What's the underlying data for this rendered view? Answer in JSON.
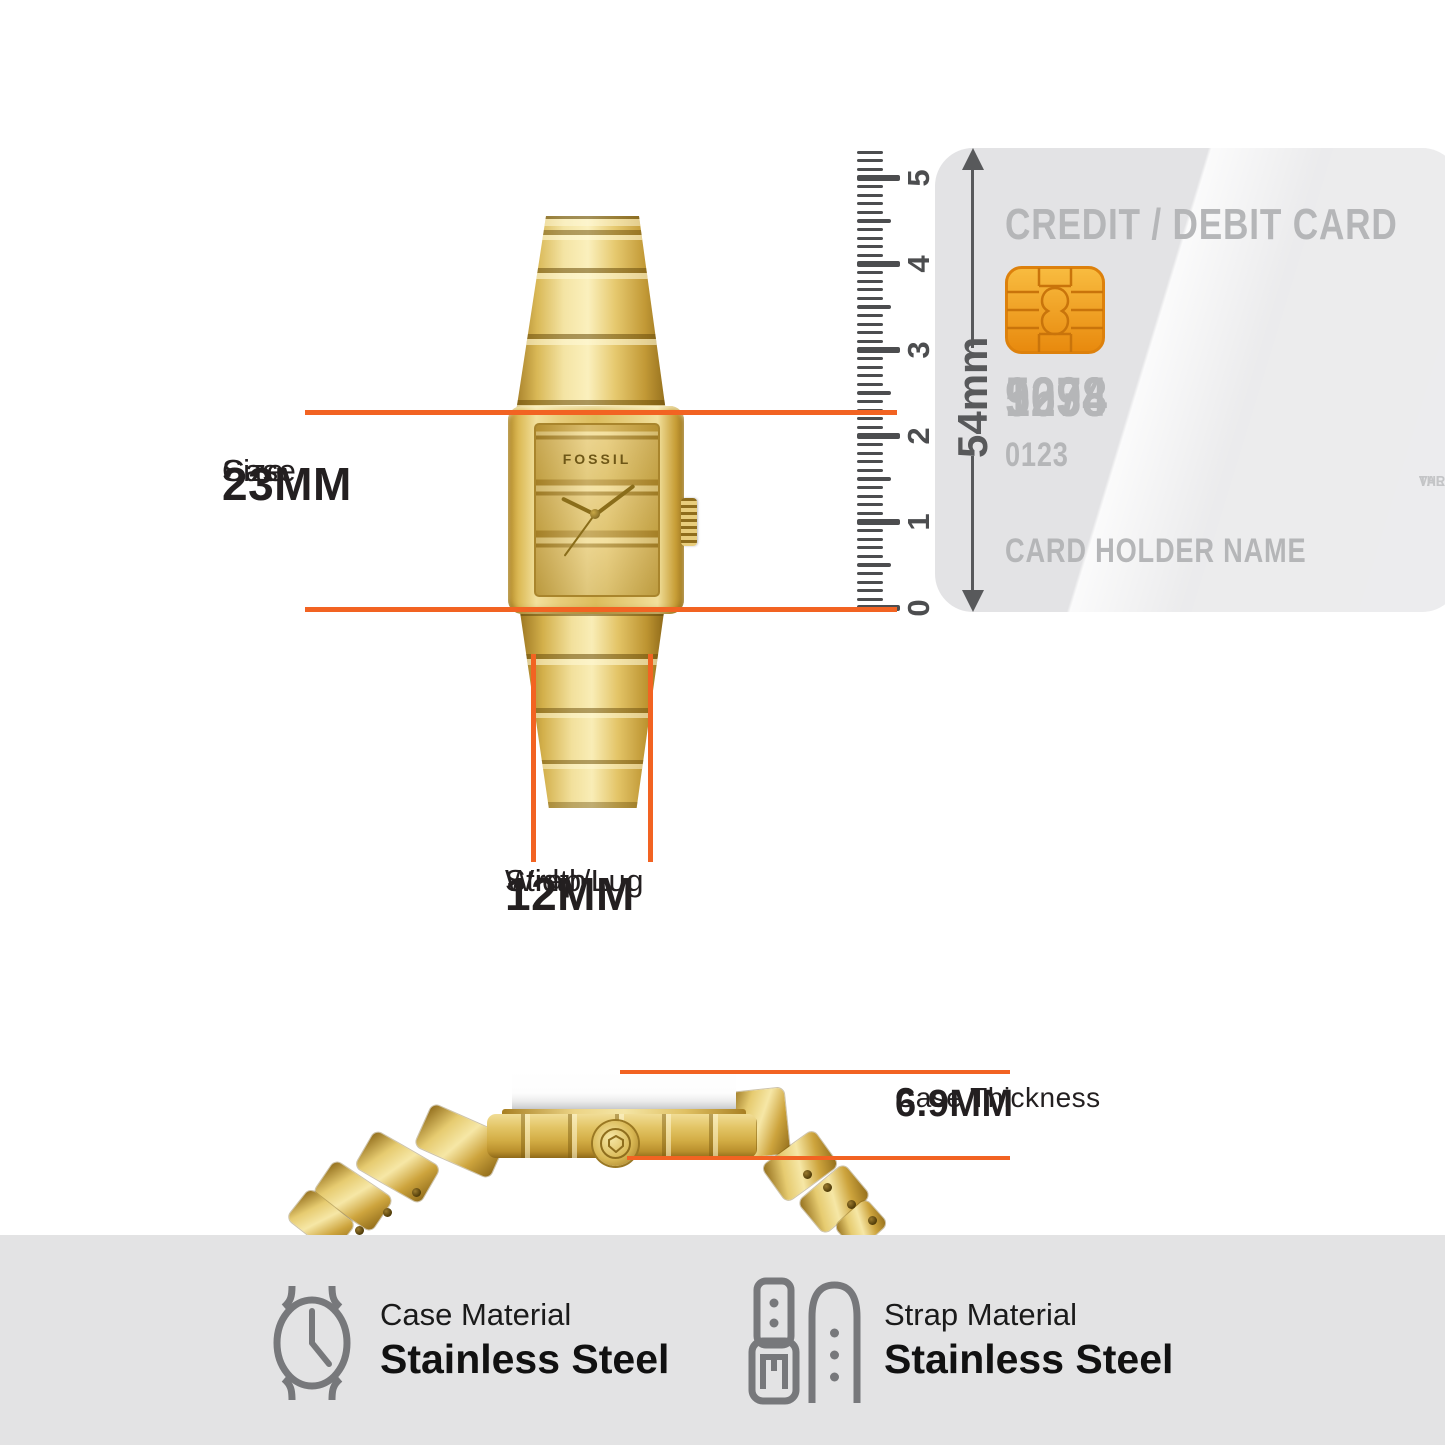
{
  "measurements": {
    "case_size": {
      "label_lines": [
        "Case",
        "Size"
      ],
      "value": "23MM"
    },
    "strap_width": {
      "label_lines": [
        "Strap/Lug",
        "Width"
      ],
      "value": "12MM"
    },
    "case_thickness": {
      "label": "Case Thickness",
      "value": "6.9MM"
    }
  },
  "ruler": {
    "max_value": 5,
    "step": 0.1,
    "overshoot": 0.3,
    "px_per_unit": 86,
    "zero_y": 608,
    "labels": [
      "0",
      "1",
      "2",
      "3",
      "4",
      "5"
    ]
  },
  "card": {
    "title": "CREDIT / DEBIT CARD",
    "height_label": "54mm",
    "number_groups": [
      "1234",
      "5678",
      "9098"
    ],
    "issue_number": "0123",
    "holder_label": "CARD HOLDER NAME",
    "edge_lines": [
      "VAL",
      "THR"
    ]
  },
  "watch": {
    "brand": "FOSSIL"
  },
  "materials": {
    "case": {
      "label": "Case Material",
      "value": "Stainless Steel"
    },
    "strap": {
      "label": "Strap Material",
      "value": "Stainless Steel"
    }
  },
  "colors": {
    "accent_orange": "#F26322",
    "ruler_gray": "#4C4D4F",
    "arrow_gray": "#58595B",
    "card_bg": "#E3E3E5",
    "card_text": "#B5B6B8",
    "chip_gold": "#F2A627",
    "band_bg": "#E3E3E4",
    "icon_gray": "#77787B",
    "watch_gold": "#D9B554"
  }
}
